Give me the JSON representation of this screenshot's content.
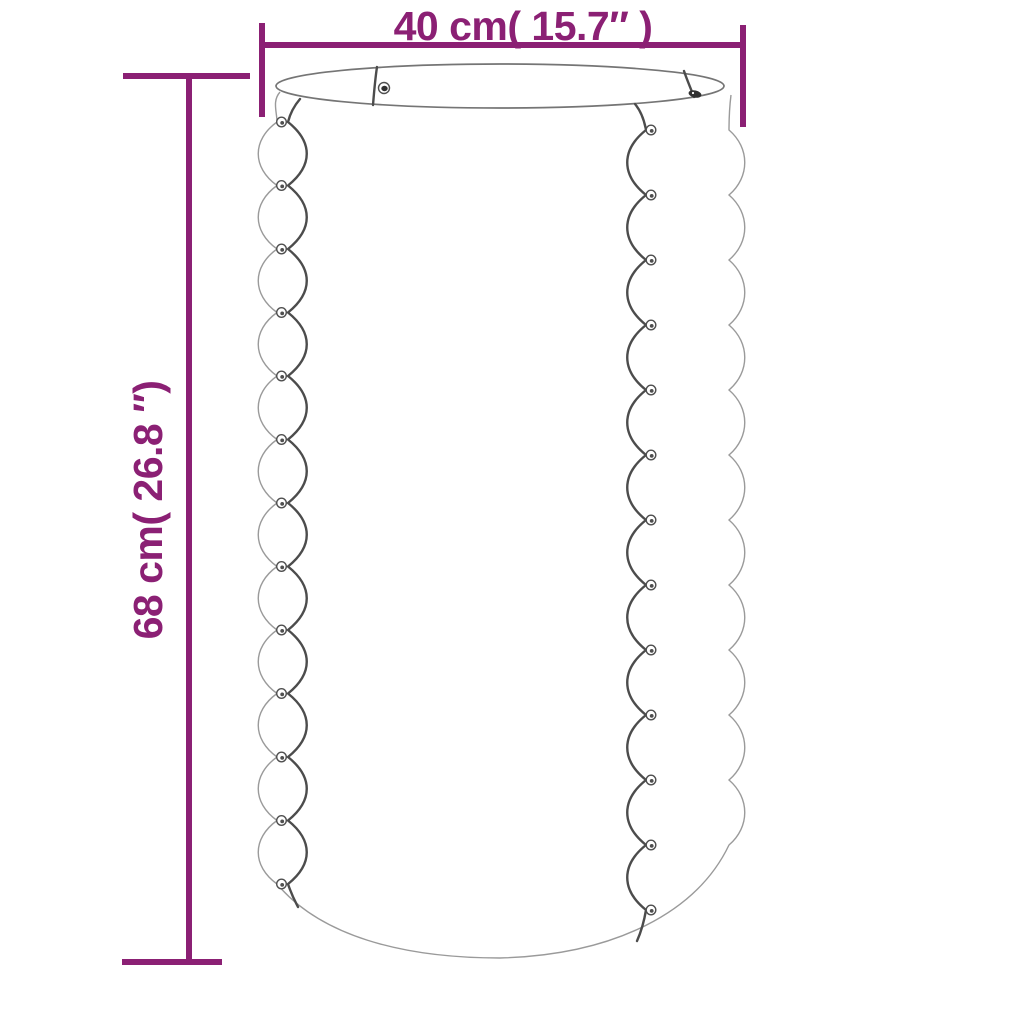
{
  "dimensions": {
    "width_label": "40 cm( 15.7″ )",
    "height_label": "68 cm( 26.8 ″)"
  },
  "colors": {
    "accent": "#8B2074",
    "outline_light": "#9A9A9A",
    "outline_dark": "#4C4C4C",
    "rim": "#757575",
    "rivet": "#4F4F4F",
    "rivet_dark": "#303030",
    "background": "#FFFFFF"
  }
}
